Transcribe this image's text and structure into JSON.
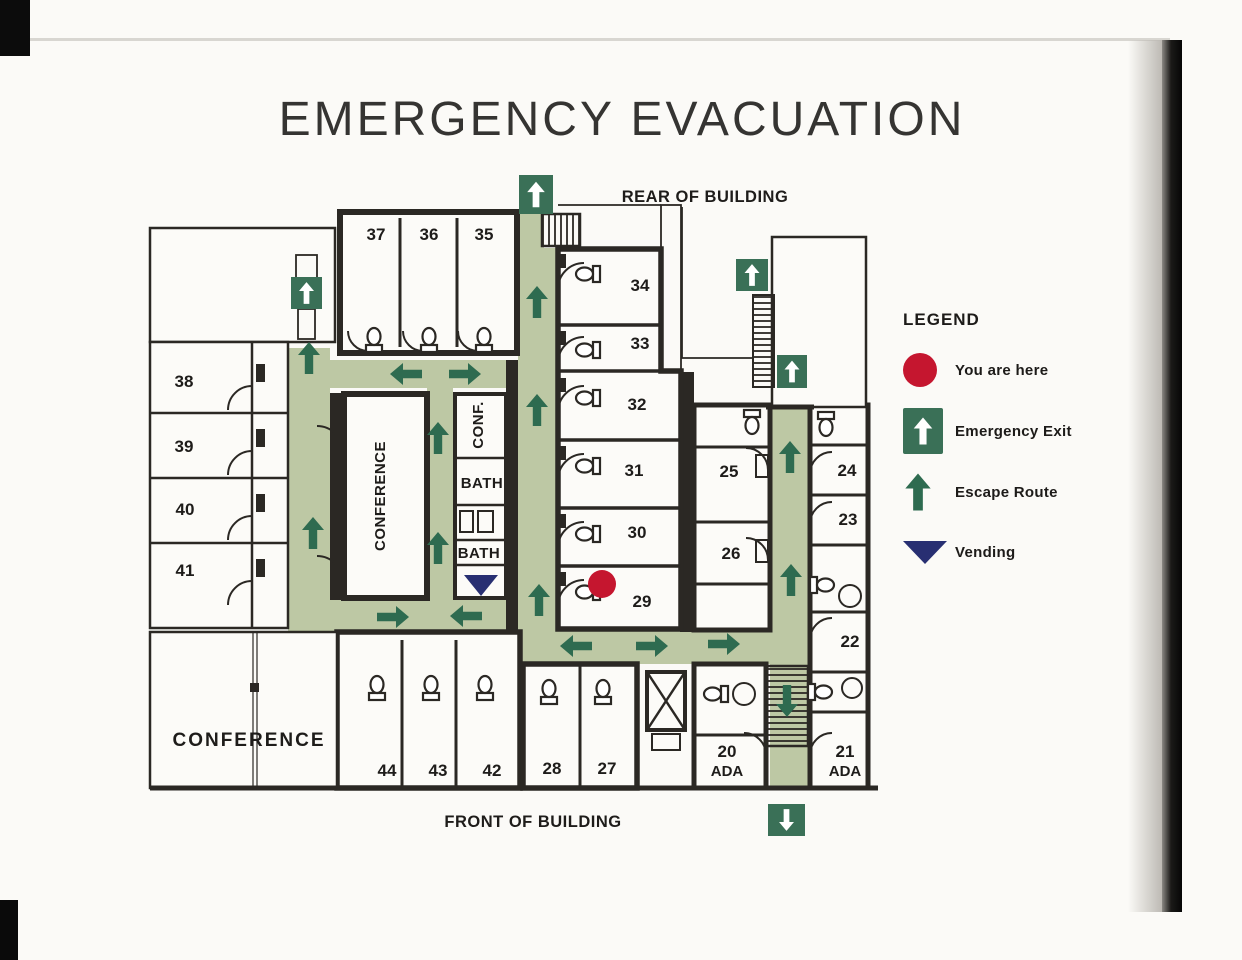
{
  "title": "EMERGENCY EVACUATION",
  "plan": {
    "rear_label": "REAR OF BUILDING",
    "front_label": "FRONT OF BUILDING",
    "rooms": {
      "r37": "37",
      "r36": "36",
      "r35": "35",
      "r38": "38",
      "r39": "39",
      "r40": "40",
      "r41": "41",
      "r34": "34",
      "r33": "33",
      "r32": "32",
      "r31": "31",
      "r30": "30",
      "r29": "29",
      "r25": "25",
      "r26": "26",
      "r24": "24",
      "r23": "23",
      "r22": "22",
      "r44": "44",
      "r43": "43",
      "r42": "42",
      "r28": "28",
      "r27": "27",
      "r20": "20",
      "r20ada": "ADA",
      "r21": "21",
      "r21ada": "ADA"
    },
    "areas": {
      "conference_vertical": "CONFERENCE",
      "conf_small": "CONF.",
      "bath_upper": "BATH",
      "bath_lower": "BATH",
      "conference_room": "CONFERENCE"
    }
  },
  "legend": {
    "heading": "LEGEND",
    "items": [
      {
        "symbol": "you-are-here-dot",
        "label": "You are here"
      },
      {
        "symbol": "emergency-exit-sign",
        "label": "Emergency Exit"
      },
      {
        "symbol": "escape-route-arrow",
        "label": "Escape Route"
      },
      {
        "symbol": "vending-triangle",
        "label": "Vending"
      }
    ]
  },
  "colors": {
    "route_corridor_green": "#bdc8a4",
    "escape_arrow_green": "#2e6b50",
    "exit_sign_green": "#3a7057",
    "you_are_here_red": "#c5162f",
    "vending_navy": "#282f72",
    "wall_dark": "#2b2824"
  }
}
